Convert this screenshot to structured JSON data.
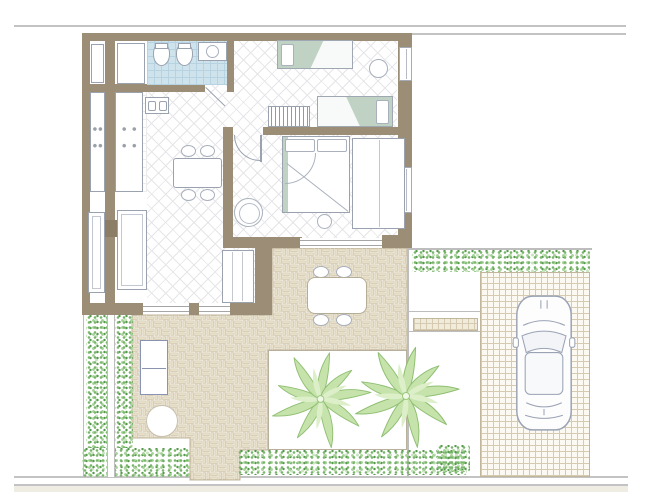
{
  "drawing": {
    "kind": "residential floor plan, top-down architectural drawing",
    "text_labels": [],
    "palm_tree_count": 2,
    "single_bed_count": 2,
    "double_bed_count": 1,
    "car_count": 1
  },
  "rooms": [
    {
      "name": "bathroom",
      "floor": "blue tile"
    },
    {
      "name": "entry-closet-room",
      "floor": "white"
    },
    {
      "name": "kitchen",
      "floor": "square tile"
    },
    {
      "name": "living-dining-room",
      "floor": "diamond lattice"
    },
    {
      "name": "kids-bedroom",
      "floor": "diamond lattice"
    },
    {
      "name": "master-bedroom",
      "floor": "diamond lattice"
    },
    {
      "name": "patio-terrace",
      "floor": "herringbone brick"
    },
    {
      "name": "palm-garden-bed",
      "floor": "white"
    },
    {
      "name": "side-garden-path",
      "floor": "white"
    },
    {
      "name": "driveway",
      "floor": "square grid paving"
    },
    {
      "name": "lawn-strip",
      "floor": "white"
    },
    {
      "name": "sidewalk",
      "floor": "light gray band"
    }
  ],
  "objects": [
    "toilet",
    "bidet",
    "washbasin-cabinet",
    "closet",
    "closet",
    "kitchen-counter",
    "cooktop",
    "kitchen-counter",
    "cooktop",
    "double-sink-island",
    "dining-table",
    "dining-chair",
    "dining-chair",
    "dining-chair",
    "dining-chair",
    "round-armchair",
    "sideboard",
    "sideboard",
    "shelf-unit",
    "single-bed",
    "single-bed",
    "radiator",
    "round-side-table",
    "double-bed",
    "wardrobe",
    "pouf",
    "outdoor-table",
    "outdoor-chair",
    "outdoor-chair",
    "outdoor-chair",
    "outdoor-chair",
    "storage-cabinet",
    "round-patio-table",
    "palm-tree",
    "palm-tree",
    "hedge",
    "car"
  ],
  "colors": {
    "wall": "#9c8d76",
    "wallDark": "#8c7d66",
    "bathTile": "#cfe3ed",
    "bathTileLine": "#b7d3e2",
    "bedGreen": "#bfd2c4",
    "brick": "#e9e0ca",
    "brickJoint": "#f8f5ed",
    "brickLine": "#cdc1a6",
    "paveLine": "#d6cbb0",
    "hedgeDark": "#55994c",
    "hedgeMid": "#79b56c",
    "hedgeLight": "#a5d397",
    "palmLeaf": "#c6e3ab",
    "palmEdge": "#8fbf72",
    "palmLight": "#dcefc9",
    "outline": "#9aa2b0",
    "floorLine": "#e6e6ea",
    "propertyLine": "#c3c3c3",
    "sidewalk": "#efece4"
  }
}
